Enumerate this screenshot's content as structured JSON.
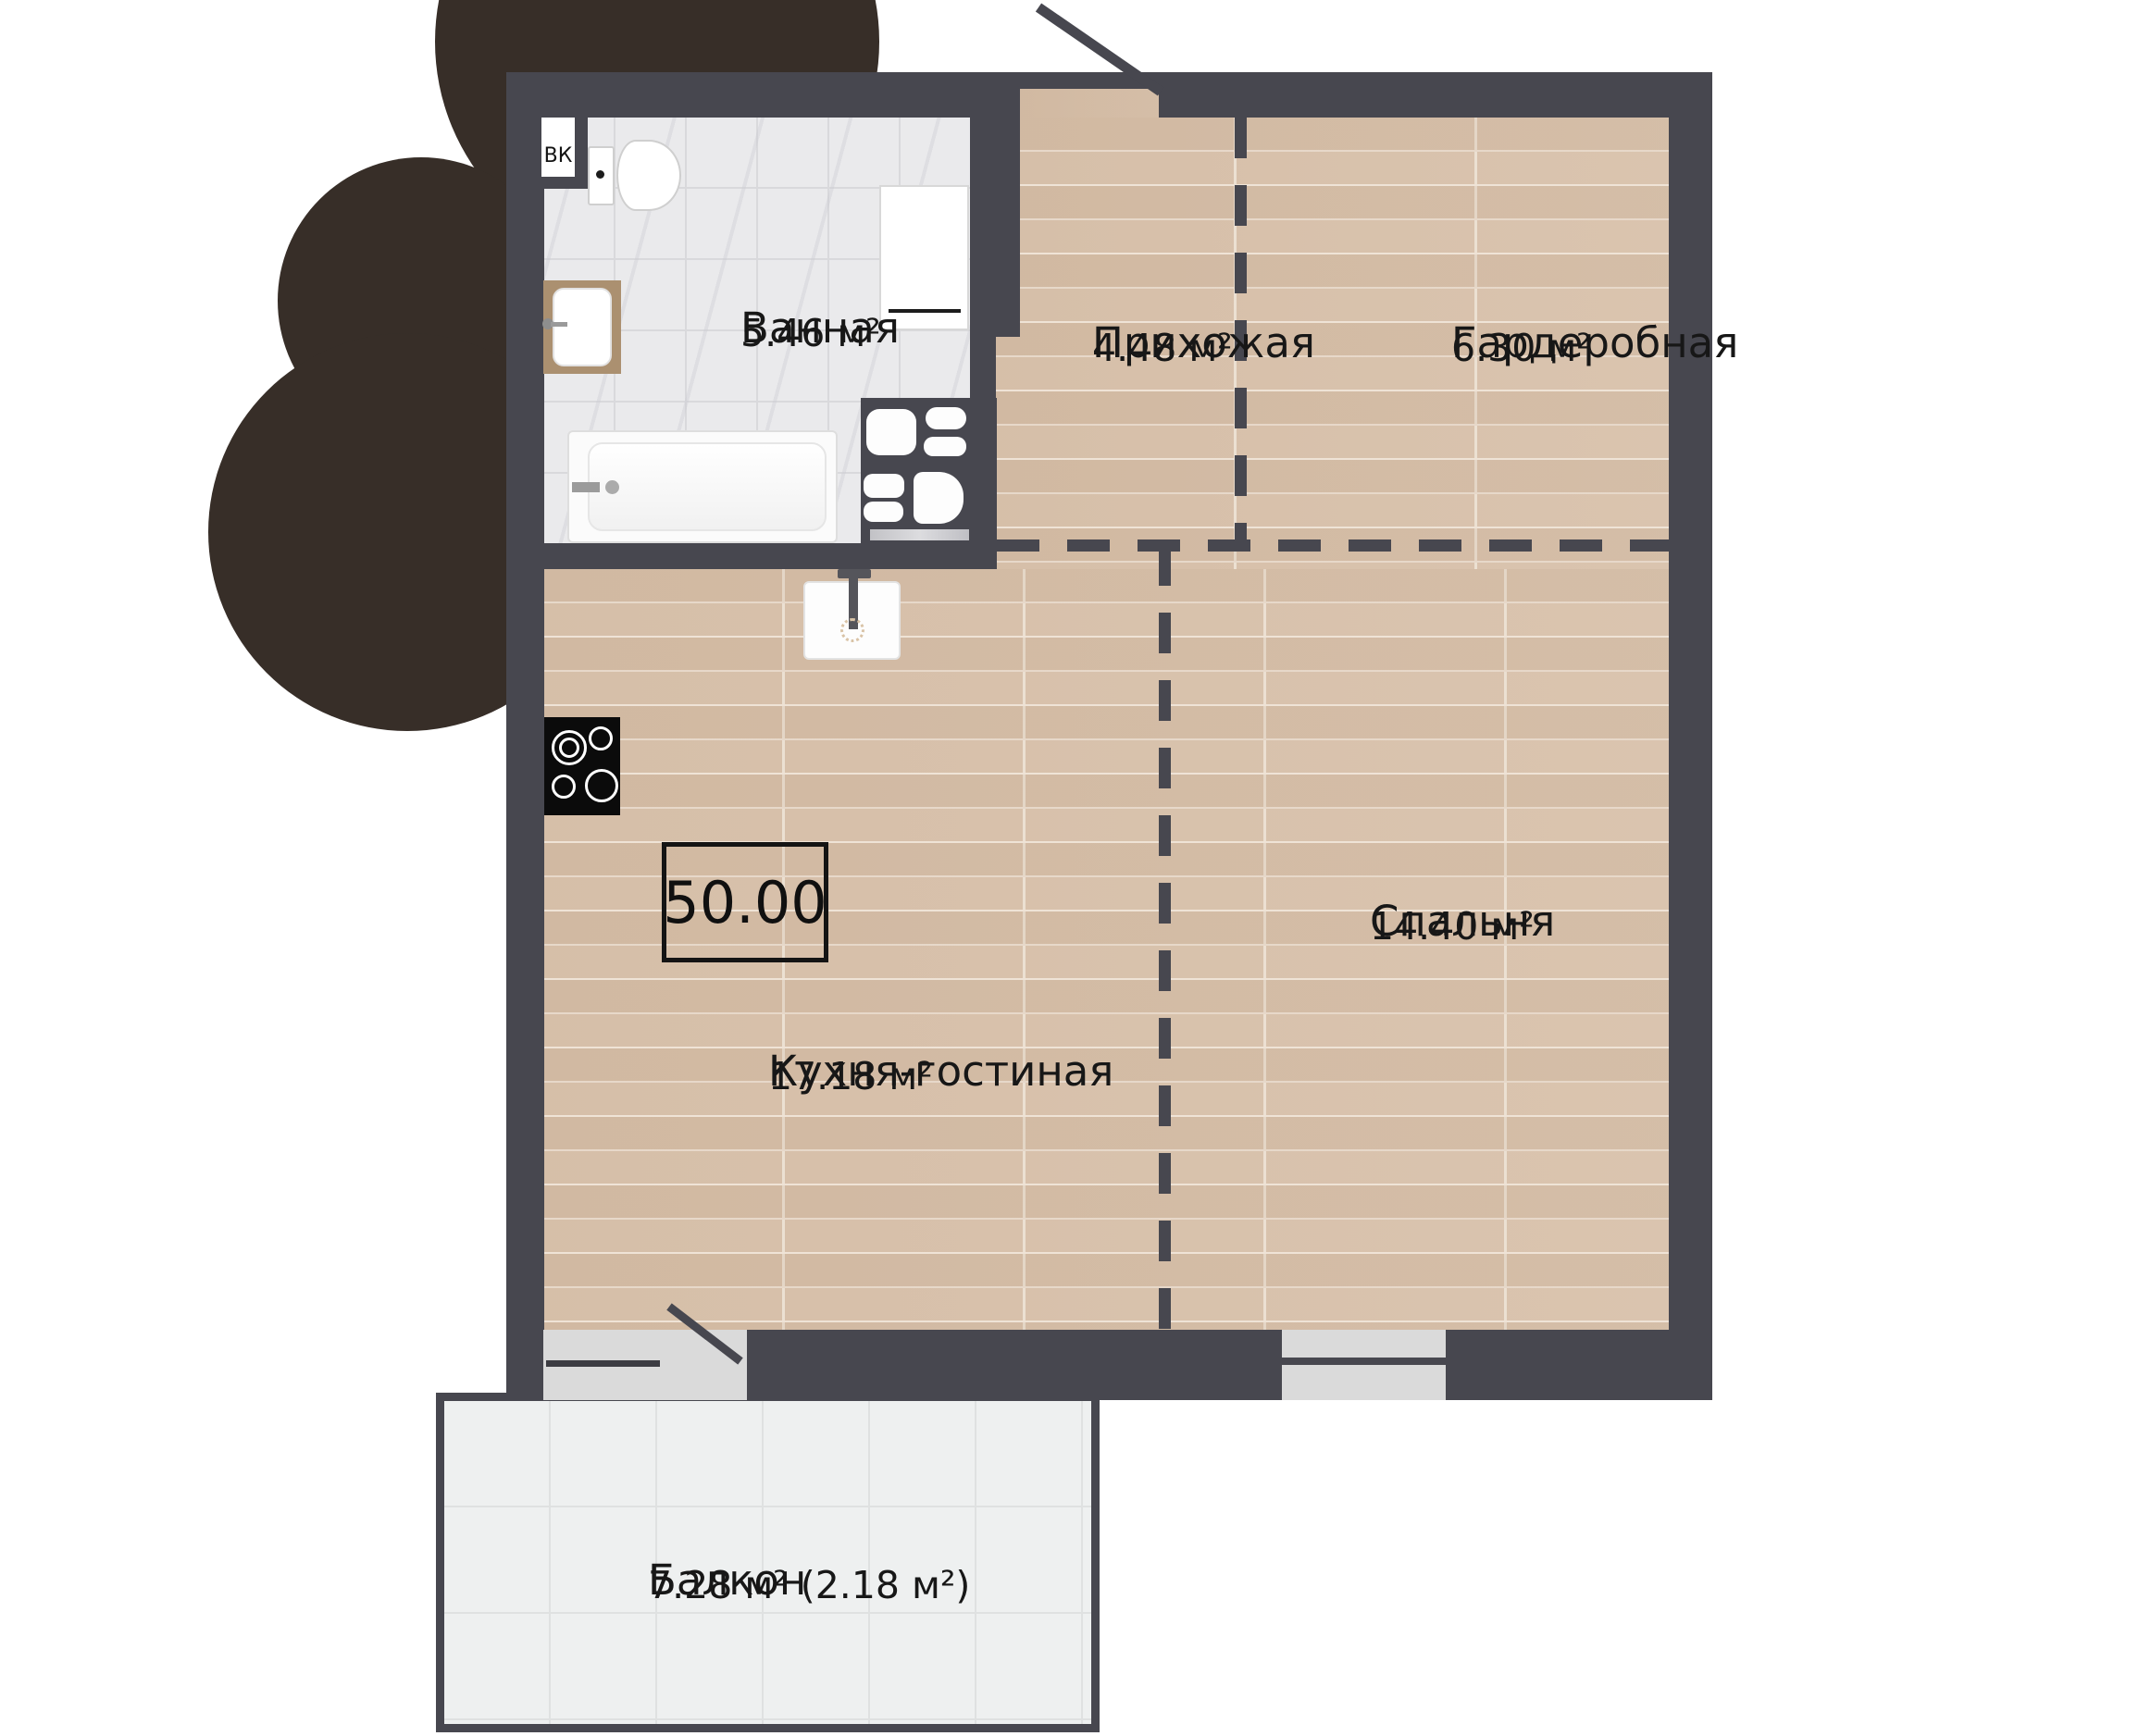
{
  "plan": {
    "total_area": "50.00",
    "vent_label": "ВК",
    "rooms": [
      {
        "id": "bathroom",
        "name": "Ванная",
        "area": "5.46 м²"
      },
      {
        "id": "hallway",
        "name": "Прихожая",
        "area": "4.48 м²"
      },
      {
        "id": "wardrobe",
        "name": "Гардеробная",
        "area": "6.30 м²"
      },
      {
        "id": "kitchen_living",
        "name": "Кухня-гостиная",
        "area": "17.18 м²"
      },
      {
        "id": "bedroom",
        "name": "Спальня",
        "area": "14.40 м²"
      },
      {
        "id": "balcony",
        "name": "Балкон",
        "area": "7.28 м² (2.18 м²)"
      }
    ],
    "colors": {
      "wall": "#47474f",
      "wood_floor": "#d9c3ae",
      "tile_floor": "#eaeaec",
      "balcony_floor": "#eef0f0",
      "landscape_accent": "#372e28",
      "opening": "#dadada",
      "text": "#171717"
    }
  }
}
